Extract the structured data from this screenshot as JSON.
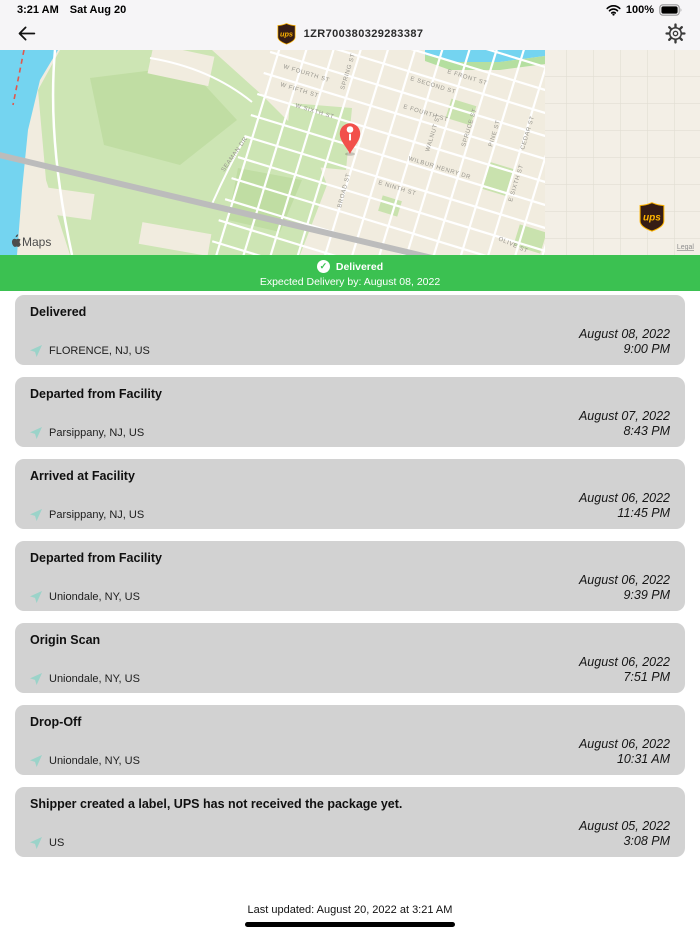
{
  "status_bar": {
    "time": "3:21 AM",
    "date": "Sat Aug 20",
    "battery_percent": "100%"
  },
  "nav": {
    "tracking_number": "1ZR700380329283387",
    "ups_logo_text": "ups"
  },
  "map": {
    "provider_logo": "Maps",
    "legal_link": "Legal",
    "street_labels": [
      {
        "text": "W FOURTH ST",
        "x": 283,
        "y": 18,
        "r": 17
      },
      {
        "text": "W FIFTH ST",
        "x": 280,
        "y": 36,
        "r": 17
      },
      {
        "text": "W SIXTH ST",
        "x": 295,
        "y": 57,
        "r": 17
      },
      {
        "text": "SPRING ST",
        "x": 344,
        "y": 40,
        "r": -73
      },
      {
        "text": "E FRONT ST",
        "x": 447,
        "y": 23,
        "r": 17
      },
      {
        "text": "E SECOND ST",
        "x": 410,
        "y": 30,
        "r": 17
      },
      {
        "text": "E FOURTH ST",
        "x": 403,
        "y": 58,
        "r": 17
      },
      {
        "text": "WALNUT ST",
        "x": 429,
        "y": 102,
        "r": -73
      },
      {
        "text": "SPRUCE ST",
        "x": 465,
        "y": 97,
        "r": -73
      },
      {
        "text": "PINE ST",
        "x": 492,
        "y": 97,
        "r": -73
      },
      {
        "text": "CEDAR ST",
        "x": 524,
        "y": 100,
        "r": -73
      },
      {
        "text": "WILBUR HENRY DR",
        "x": 408,
        "y": 110,
        "r": 17
      },
      {
        "text": "E NINTH ST",
        "x": 378,
        "y": 134,
        "r": 17
      },
      {
        "text": "E SIXTH ST",
        "x": 512,
        "y": 152,
        "r": -73
      },
      {
        "text": "OLIVE ST",
        "x": 498,
        "y": 190,
        "r": 24
      },
      {
        "text": "SEAMAN DR",
        "x": 224,
        "y": 122,
        "r": -55
      },
      {
        "text": "BROAD ST",
        "x": 341,
        "y": 158,
        "r": -75
      }
    ]
  },
  "banner": {
    "status": "Delivered",
    "check_icon": "✓",
    "expected_line": "Expected Delivery by: August 08, 2022",
    "color": "#3bc151"
  },
  "events": [
    {
      "title": "Delivered",
      "location": "FLORENCE, NJ, US",
      "date": "August 08, 2022",
      "time": "9:00 PM"
    },
    {
      "title": "Departed from Facility",
      "location": "Parsippany, NJ, US",
      "date": "August 07, 2022",
      "time": "8:43 PM"
    },
    {
      "title": "Arrived at Facility",
      "location": "Parsippany, NJ, US",
      "date": "August 06, 2022",
      "time": "11:45 PM"
    },
    {
      "title": "Departed from Facility",
      "location": "Uniondale, NY, US",
      "date": "August 06, 2022",
      "time": "9:39 PM"
    },
    {
      "title": "Origin Scan",
      "location": "Uniondale, NY, US",
      "date": "August 06, 2022",
      "time": "7:51 PM"
    },
    {
      "title": "Drop-Off",
      "location": "Uniondale, NY, US",
      "date": "August 06, 2022",
      "time": "10:31 AM"
    },
    {
      "title": "Shipper created a label, UPS has not received the package yet.",
      "location": "US",
      "date": "August 05, 2022",
      "time": "3:08 PM"
    }
  ],
  "footer": {
    "last_updated": "Last updated: August 20, 2022 at 3:21 AM"
  },
  "colors": {
    "banner_green": "#3bc151",
    "card_gray": "#d2d2d2",
    "ups_brown": "#351c15",
    "ups_gold": "#ffb500",
    "pin_red": "#f2504b",
    "location_arrow": "#9bd3c9"
  }
}
